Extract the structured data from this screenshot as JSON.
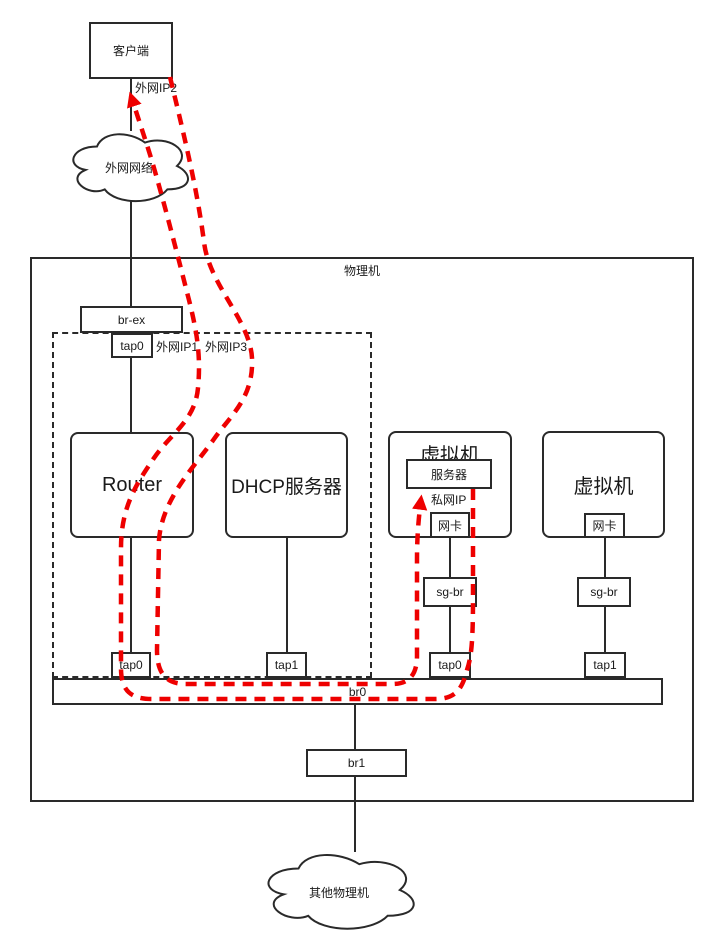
{
  "client": {
    "label": "客户端"
  },
  "external_network": {
    "label": "外网网络"
  },
  "ip_labels": {
    "ext_ip1": "外网IP1",
    "ext_ip2": "外网IP2",
    "ext_ip3": "外网IP3",
    "private_ip": "私网IP"
  },
  "physical_machine": {
    "label": "物理机"
  },
  "bridges": {
    "br_ex": "br-ex",
    "br0": "br0",
    "br1": "br1"
  },
  "namespace": {
    "router": "Router",
    "dhcp": "DHCP服务器"
  },
  "taps": {
    "brex": "tap0",
    "router": "tap0",
    "dhcp": "tap1",
    "vm1": "tap0",
    "vm2": "tap1"
  },
  "vm1": {
    "label": "虚拟机",
    "server": "服务器",
    "nic": "网卡",
    "sg_bridge": "sg-br"
  },
  "vm2": {
    "label": "虚拟机",
    "nic": "网卡",
    "sg_bridge": "sg-br"
  },
  "other_hosts": {
    "label": "其他物理机"
  },
  "colors": {
    "stroke": "#2a2a2a",
    "flow_path": "#ee0000",
    "box_fill": "#ffffff"
  }
}
